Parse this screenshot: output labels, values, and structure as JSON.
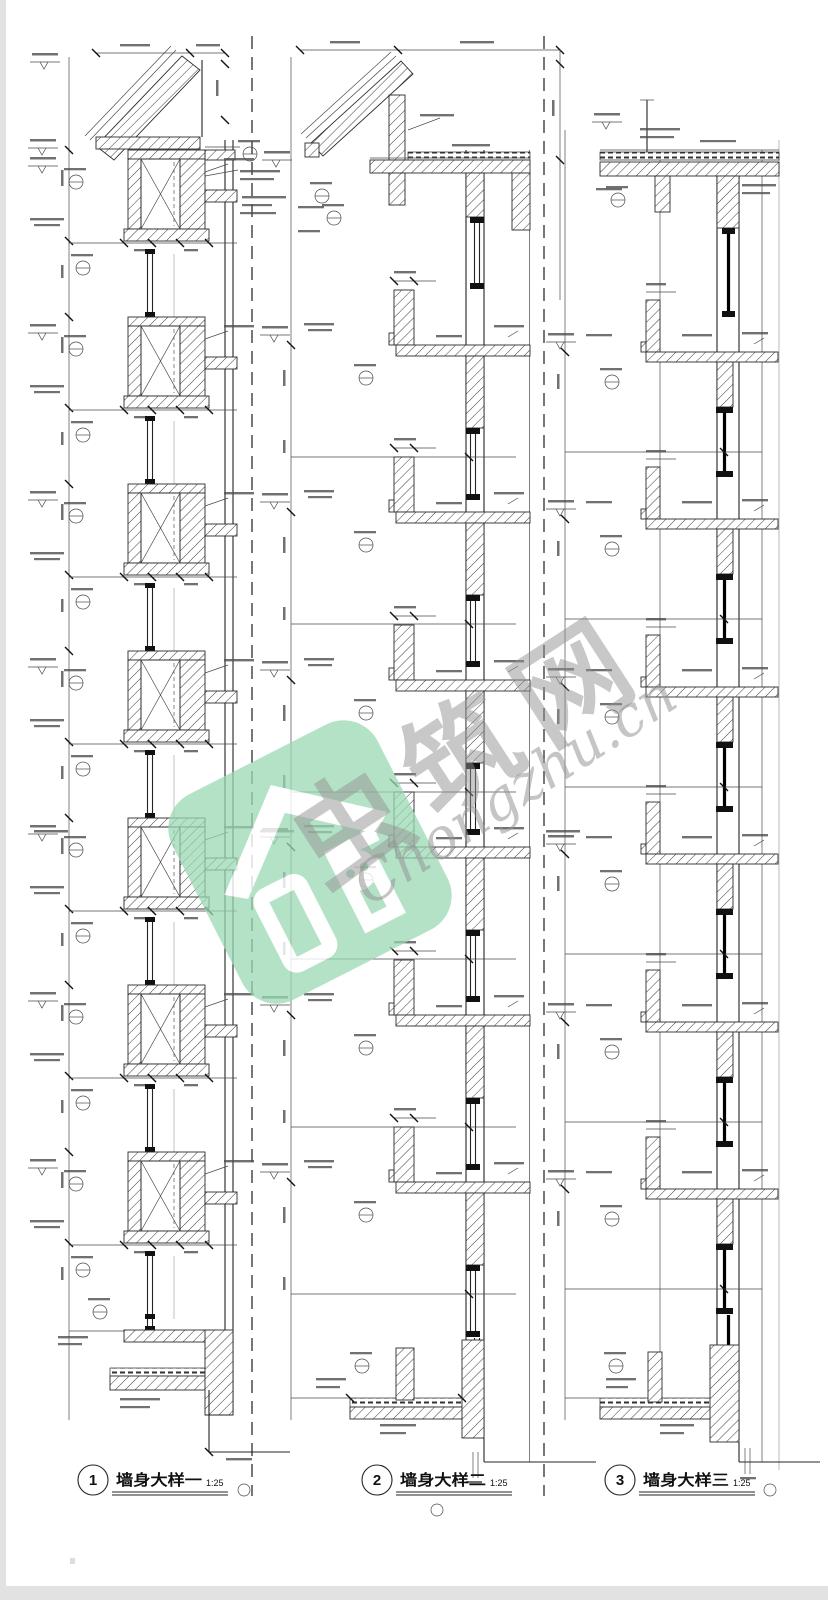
{
  "sheet": {
    "background": "#ffffff",
    "edge_shade": "#e2e2e2",
    "line_color": "#222222",
    "hatch_color": "#3a3a3a"
  },
  "watermark": {
    "brand": "虫筑网",
    "domain": "Chongzhu.cn",
    "logo_color": "#9ad8b4",
    "text_color": "#9a9a9a"
  },
  "figures": [
    {
      "number": "1",
      "title": "墙身大样一",
      "scale": "1:25"
    },
    {
      "number": "2",
      "title": "墙身大样二",
      "scale": "1:25"
    },
    {
      "number": "3",
      "title": "墙身大样三",
      "scale": "1:25"
    }
  ]
}
